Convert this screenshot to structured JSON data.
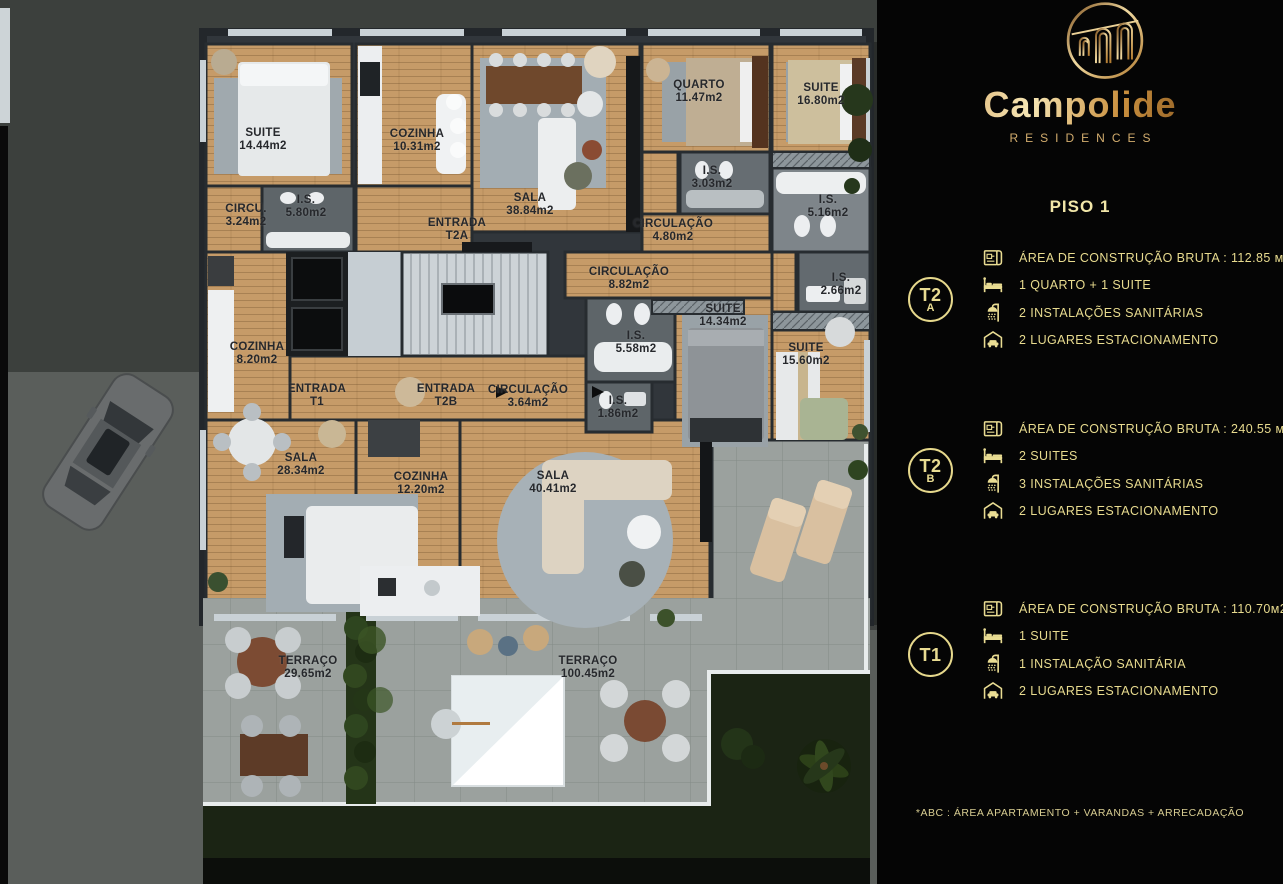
{
  "brand": {
    "name": "Campolide",
    "subtitle": "RESIDENCES"
  },
  "floor_title": "PISO 1",
  "units": [
    {
      "id": "T2A",
      "badge": {
        "line1": "T2",
        "line2": "A"
      },
      "specs": [
        {
          "icon": "blueprint-icon",
          "text": "ÁREA DE CONSTRUÇÃO BRUTA :  112.85 м2*"
        },
        {
          "icon": "bed-icon",
          "text": "1 QUARTO + 1 SUITE"
        },
        {
          "icon": "shower-icon",
          "text": "2 INSTALAÇÕES SANITÁRIAS"
        },
        {
          "icon": "garage-icon",
          "text": "2 LUGARES ESTACIONAMENTO"
        }
      ]
    },
    {
      "id": "T2B",
      "badge": {
        "line1": "T2",
        "line2": "B"
      },
      "specs": [
        {
          "icon": "blueprint-icon",
          "text": "ÁREA DE CONSTRUÇÃO BRUTA :  240.55 м2*"
        },
        {
          "icon": "bed-icon",
          "text": "2 SUITES"
        },
        {
          "icon": "shower-icon",
          "text": "3 INSTALAÇÕES SANITÁRIAS"
        },
        {
          "icon": "garage-icon",
          "text": "2 LUGARES ESTACIONAMENTO"
        }
      ]
    },
    {
      "id": "T1",
      "badge": {
        "line1": "T1",
        "line2": ""
      },
      "specs": [
        {
          "icon": "blueprint-icon",
          "text": "ÁREA DE CONSTRUÇÃO BRUTA :  110.70м2*"
        },
        {
          "icon": "bed-icon",
          "text": "1 SUITE"
        },
        {
          "icon": "shower-icon",
          "text": "1 INSTALAÇÃO SANITÁRIA"
        },
        {
          "icon": "garage-icon",
          "text": "2 LUGARES ESTACIONAMENTO"
        }
      ]
    }
  ],
  "footnote": "*ABC :  ÁREA APARTAMENTO + VARANDAS + ARRECADAÇÃO",
  "colors": {
    "accent_gold": "#e9dc92",
    "logo_gold_dark": "#8a5a22",
    "logo_gold_light": "#f2dda4",
    "panel_bg": "#050505",
    "wood_floor": "#c69b68",
    "terrace_tile": "#9ba19e"
  },
  "floorplan": {
    "rooms": [
      {
        "name": "SUITE",
        "area": "14.44m2",
        "x": 263,
        "y": 140
      },
      {
        "name": "COZINHA",
        "area": "10.31m2",
        "x": 417,
        "y": 141
      },
      {
        "name": "CIRCU.",
        "area": "3.24m2",
        "x": 246,
        "y": 216
      },
      {
        "name": "I.S.",
        "area": "5.80m2",
        "x": 306,
        "y": 207
      },
      {
        "name": "ENTRADA",
        "area": "T2A",
        "x": 457,
        "y": 230
      },
      {
        "name": "SALA",
        "area": "38.84m2",
        "x": 530,
        "y": 205
      },
      {
        "name": "QUARTO",
        "area": "11.47m2",
        "x": 699,
        "y": 92
      },
      {
        "name": "SUITE",
        "area": "16.80m2",
        "x": 821,
        "y": 95
      },
      {
        "name": "I.S.",
        "area": "3.03m2",
        "x": 712,
        "y": 178
      },
      {
        "name": "CIRCULAÇÃO",
        "area": "4.80m2",
        "x": 673,
        "y": 231
      },
      {
        "name": "I.S.",
        "area": "5.16m2",
        "x": 828,
        "y": 207
      },
      {
        "name": "CIRCULAÇÃO",
        "area": "8.82m2",
        "x": 629,
        "y": 279
      },
      {
        "name": "I.S.",
        "area": "2.66m2",
        "x": 841,
        "y": 285
      },
      {
        "name": "SUITE",
        "area": "14.34m2",
        "x": 723,
        "y": 316
      },
      {
        "name": "I.S.",
        "area": "5.58m2",
        "x": 636,
        "y": 343
      },
      {
        "name": "SUITE",
        "area": "15.60m2",
        "x": 806,
        "y": 355
      },
      {
        "name": "COZINHA",
        "area": "8.20m2",
        "x": 257,
        "y": 354
      },
      {
        "name": "ENTRADA",
        "area": "T1",
        "x": 317,
        "y": 396
      },
      {
        "name": "ENTRADA",
        "area": "T2B",
        "x": 446,
        "y": 396
      },
      {
        "name": "CIRCULAÇÃO",
        "area": "3.64m2",
        "x": 528,
        "y": 397
      },
      {
        "name": "I.S.",
        "area": "1.86m2",
        "x": 618,
        "y": 408
      },
      {
        "name": "SALA",
        "area": "28.34m2",
        "x": 301,
        "y": 465
      },
      {
        "name": "COZINHA",
        "area": "12.20m2",
        "x": 421,
        "y": 484
      },
      {
        "name": "SALA",
        "area": "40.41m2",
        "x": 553,
        "y": 483
      },
      {
        "name": "TERRAÇO",
        "area": "29.65m2",
        "x": 308,
        "y": 668
      },
      {
        "name": "TERRAÇO",
        "area": "100.45m2",
        "x": 588,
        "y": 668
      }
    ]
  }
}
